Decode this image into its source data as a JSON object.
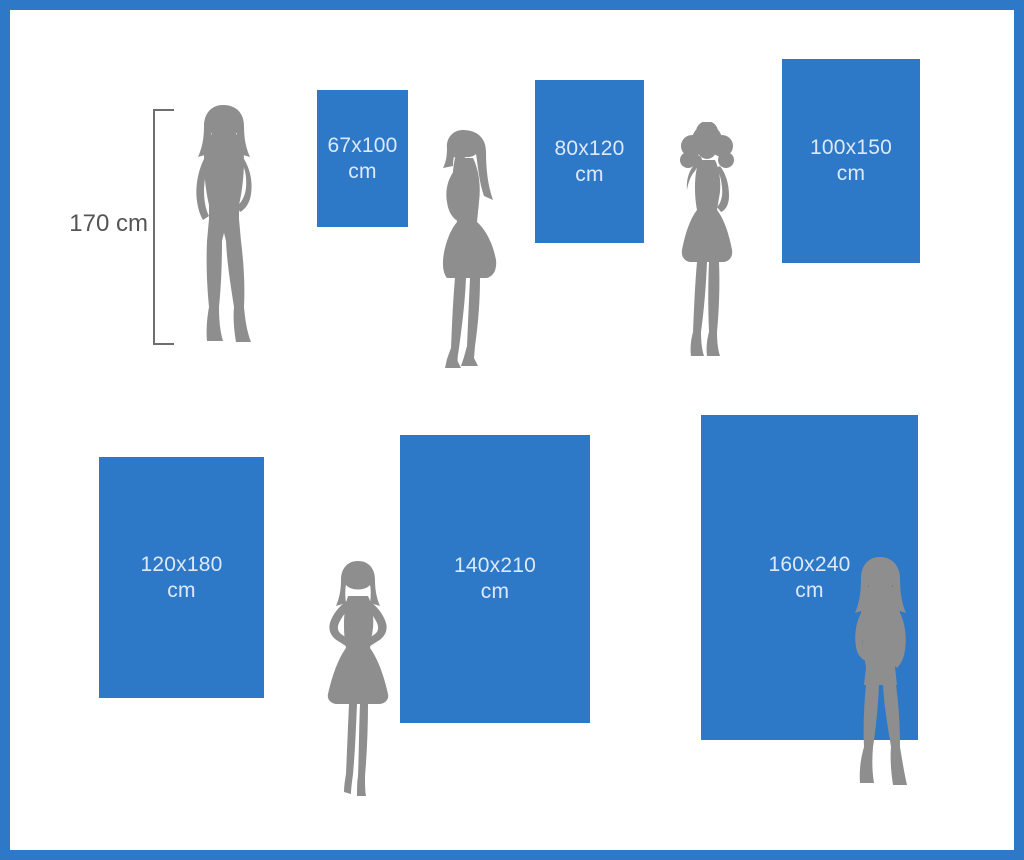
{
  "colors": {
    "accent_blue": "#2e78c8",
    "silhouette_gray": "#8e8e8e",
    "measure_line": "#6e6e6e",
    "measure_text": "#555555",
    "label_on_blue": "#dde9f8",
    "bg": "#ffffff"
  },
  "measure": {
    "label": "170 cm"
  },
  "panels": [
    {
      "size": "67x100",
      "unit": "cm"
    },
    {
      "size": "80x120",
      "unit": "cm"
    },
    {
      "size": "100x150",
      "unit": "cm"
    },
    {
      "size": "120x180",
      "unit": "cm"
    },
    {
      "size": "140x210",
      "unit": "cm"
    },
    {
      "size": "160x240",
      "unit": "cm"
    }
  ]
}
